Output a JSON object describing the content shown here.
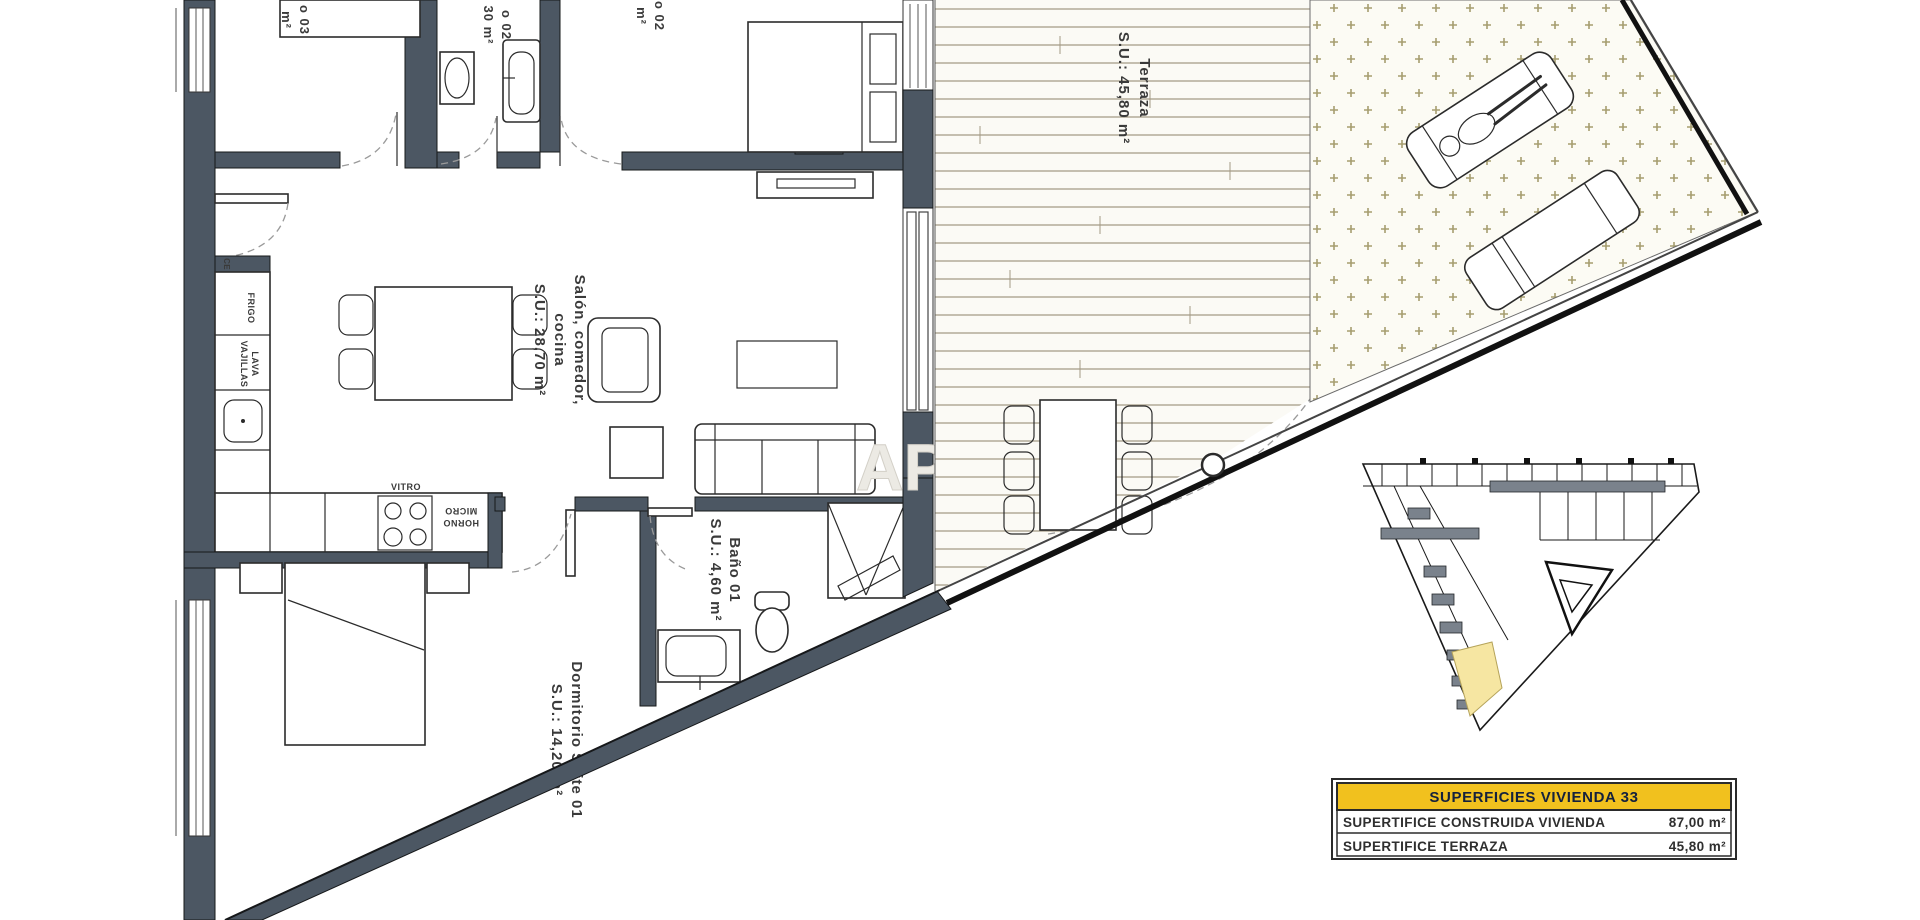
{
  "labels": {
    "terraza": {
      "line1": "Terraza",
      "line2": "S.U.: 45,80 m²"
    },
    "salon": {
      "line1": "Salón, comedor,",
      "line2": "cocina",
      "line3": "S.U.: 28,70 m²"
    },
    "bano01": {
      "line1": "Baño 01",
      "line2": "S.U.: 4,60 m²"
    },
    "suite": {
      "line1": "Dormitorio Suite 01",
      "line2": "S.U.: 14,20 m²"
    },
    "dorm03_cut": {
      "line1": "o 03",
      "line2": "m²"
    },
    "bano02_cut": {
      "line1": "o 02",
      "line2": "30 m²"
    },
    "dorm02_cut": {
      "line1": "o 02",
      "line2": "m²"
    },
    "kitchen": {
      "vitro": "VITRO",
      "horno": "HORNO",
      "micro": "MICRO",
      "frigo": "FRIGO",
      "lava": "LAVA",
      "vajillas": "VAJILLAS",
      "ce": "CE"
    },
    "watermark": "AP"
  },
  "summary_table": {
    "header": "SUPERFICIES VIVIENDA 33",
    "rows": [
      {
        "label": "SUPERTIFICE CONSTRUIDA VIVIENDA",
        "value": "87,00 m²"
      },
      {
        "label": "SUPERTIFICE TERRAZA",
        "value": "45,80 m²"
      }
    ]
  },
  "colors": {
    "wall": "#4c5763",
    "accent_yellow": "#f1c11e",
    "deck_line": "#a39a85",
    "hatch_cross": "#a69e6f",
    "unit_highlight": "#f6e6a2",
    "header_text": "#14213d"
  }
}
